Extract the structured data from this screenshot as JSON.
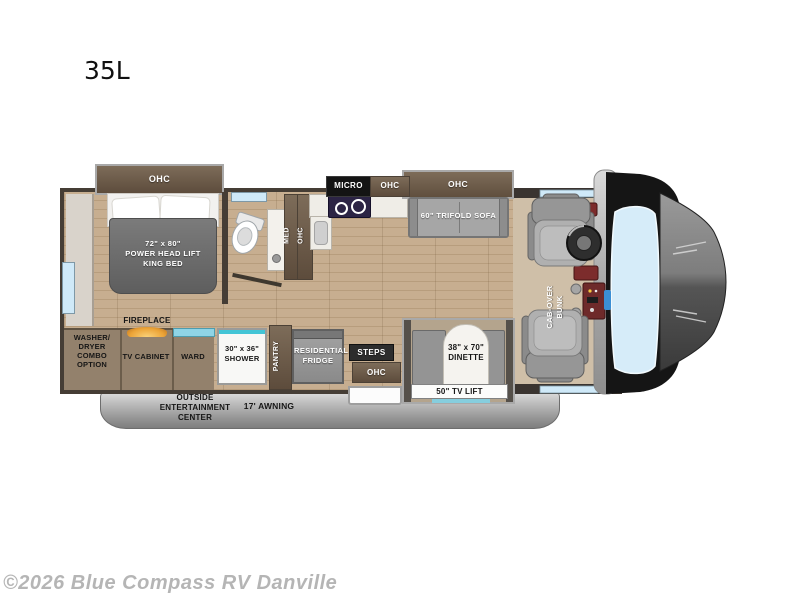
{
  "page": {
    "title": "35L",
    "copyright": "©2026 Blue Compass RV Danville"
  },
  "colors": {
    "floor_wood": "#c7ae90",
    "cabinet_brown": "#6d5c4b",
    "wall_dark": "#453d35",
    "window_blue": "#cfe9f8",
    "accent_teal": "#43c5d6",
    "fireplace_amber": "#eca437",
    "mattress_gray": "#6e6e6e",
    "awning_gray": "#a9a9a9"
  },
  "floorplan": {
    "bedroom": {
      "ohc_label": "OHC",
      "bed_label": "72\" x 80\"\nPOWER  HEAD LIFT\nKING BED",
      "fireplace_label": "FIREPLACE"
    },
    "bathroom": {
      "med_label": "MED",
      "ohc_label": "OHC"
    },
    "kitchen": {
      "micro_label": "MICRO",
      "ohc_label": "OHC",
      "pantry_label": "PANTRY",
      "fridge_label": "RESIDENTIAL\nFRIDGE"
    },
    "living": {
      "sofa_ohc_label": "OHC",
      "sofa_label": "60\" TRIFOLD SOFA",
      "dinette_label": "38\" x 70\"\nDINETTE",
      "tv_lift_label": "50\" TV LIFT"
    },
    "storage": {
      "washer_label": "WASHER/\nDRYER\nCOMBO\nOPTION",
      "tv_cabinet_label": "TV CABINET",
      "ward_label": "WARD",
      "shower_label": "30\" x 36\"\nSHOWER"
    },
    "entry": {
      "steps_label": "STEPS",
      "ohc_label": "OHC"
    },
    "cab": {
      "bunk_label": "CAB-OVER\nBUNK"
    },
    "exterior": {
      "entertainment_label": "OUTSIDE\nENTERTAINMENT\nCENTER",
      "awning_label": "17' AWNING"
    }
  }
}
